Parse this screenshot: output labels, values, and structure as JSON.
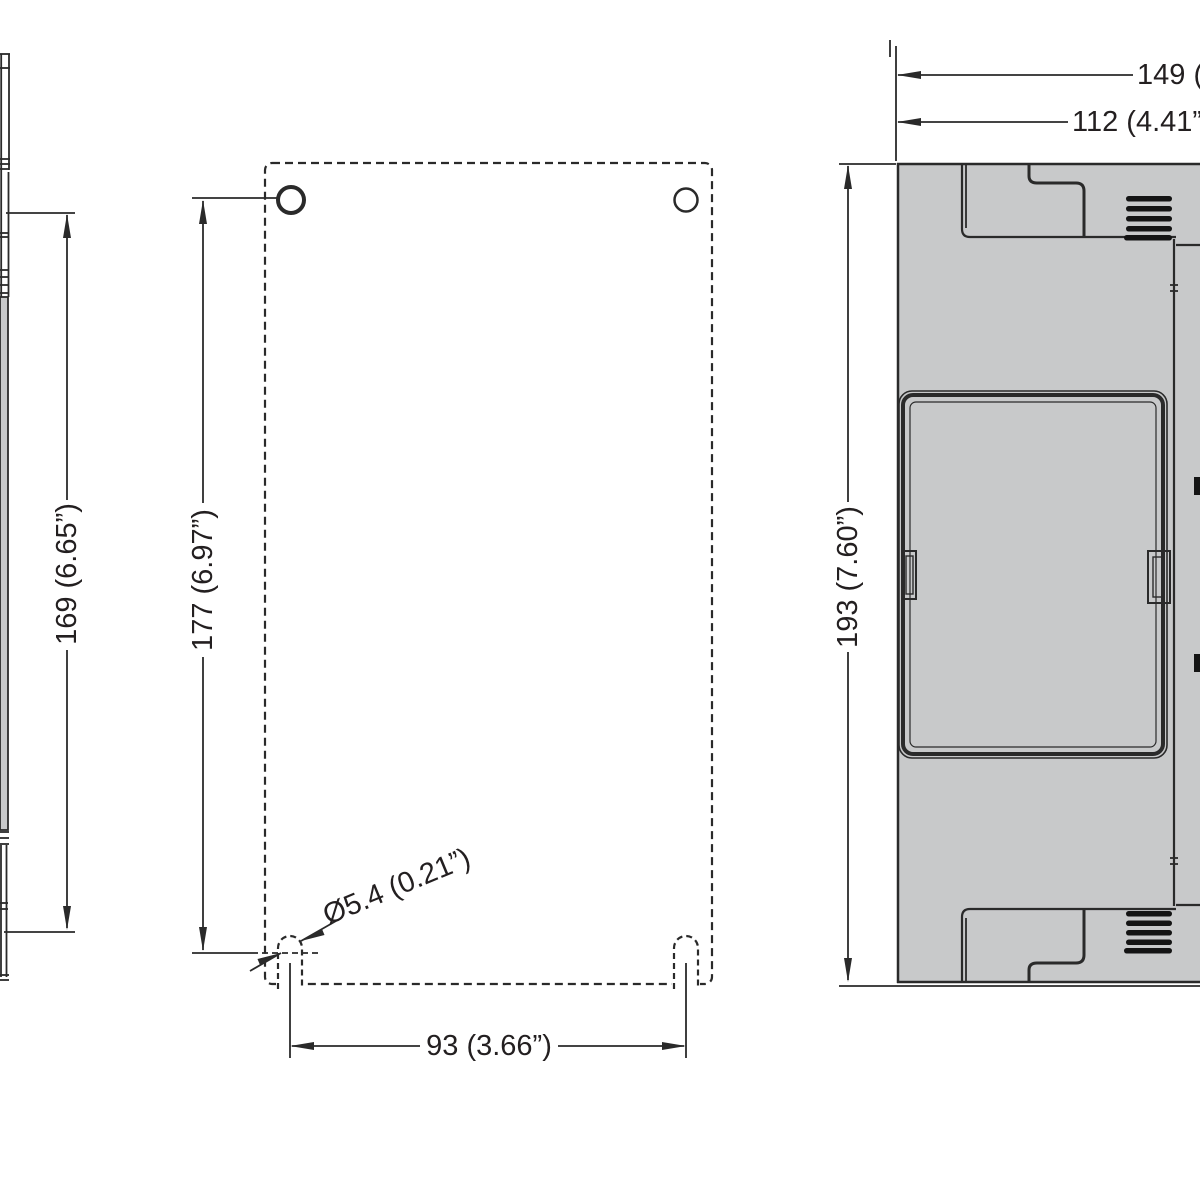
{
  "drawing": {
    "type": "mechanical-dimension-drawing",
    "views": {
      "side_profile_left": "partial side profile strip",
      "mounting_plate": "dashed mounting plate outline with holes and slots",
      "side_view_right": "device side view with vents and cover"
    }
  },
  "dimensions": {
    "hole_to_slot_side": {
      "label": "169 (6.65”)"
    },
    "plate_hole_to_slot": {
      "label": "177 (6.97”)"
    },
    "slot_spacing": {
      "label": "93 (3.66”)"
    },
    "slot_diameter": {
      "label": "Ø5.4 (0.21”)"
    },
    "overall_height": {
      "label": "193 (7.60”)"
    },
    "depth_total": {
      "label": "149 ("
    },
    "depth_partial": {
      "label": "112 (4.41”)"
    }
  },
  "colors": {
    "background": "#ffffff",
    "line": "#2a2a2a",
    "text": "#231f20",
    "body_gray": "#c8c9ca",
    "vent_black": "#141414"
  }
}
